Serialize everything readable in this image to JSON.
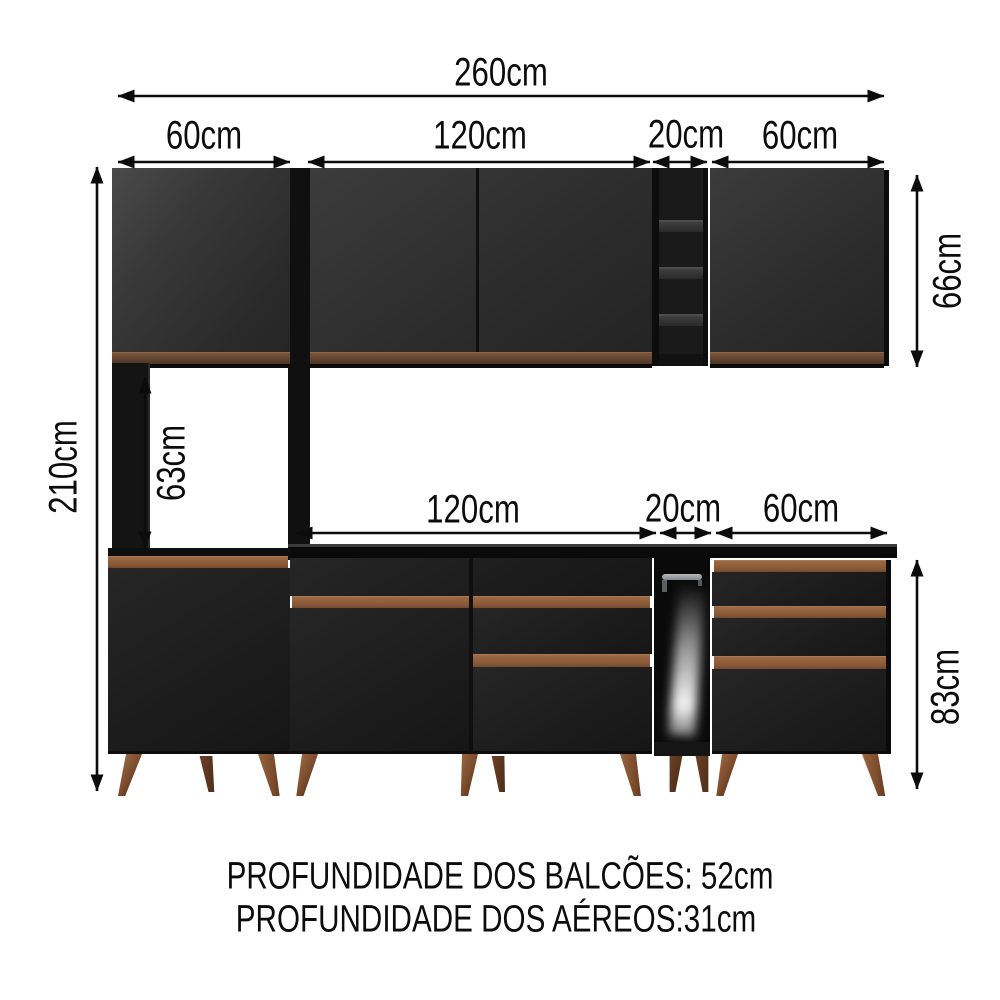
{
  "diagram": {
    "dimensions": {
      "total_width": "260cm",
      "upper_left_cabinet_width": "60cm",
      "upper_middle_cabinet_width": "120cm",
      "upper_shelf_width": "20cm",
      "upper_right_cabinet_width": "60cm",
      "counter_width": "120cm",
      "niche_width": "20cm",
      "base_right_cabinet_width": "60cm",
      "total_height": "210cm",
      "tower_opening_height": "63cm",
      "upper_cabinet_height": "66cm",
      "base_cabinet_height": "83cm"
    },
    "footer": {
      "line1": "PROFUNDIDADE DOS BALCÕES: 52cm",
      "line2": "PROFUNDIDADE DOS AÉREOS:31cm"
    },
    "colors": {
      "background": "#ffffff",
      "cabinet_black": "#1e1e1e",
      "wood_handle": "#8a5a38",
      "wood_handle_dark": "#5e4230",
      "leg_wood": "#7c4c2c",
      "dimension_ink": "#0c0c0c"
    }
  }
}
